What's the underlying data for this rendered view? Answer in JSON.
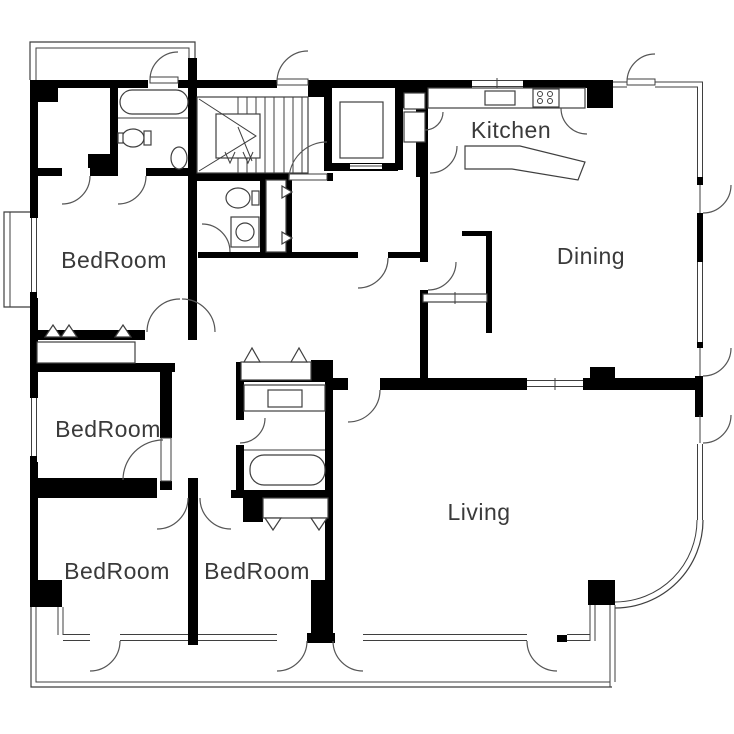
{
  "plan": {
    "rooms": [
      {
        "id": "kitchen",
        "label": "Kitchen"
      },
      {
        "id": "dining",
        "label": "Dining"
      },
      {
        "id": "living",
        "label": "Living"
      },
      {
        "id": "bedroom-nw",
        "label": "BedRoom"
      },
      {
        "id": "bedroom-w",
        "label": "BedRoom"
      },
      {
        "id": "bedroom-sw",
        "label": "BedRoom"
      },
      {
        "id": "bedroom-s",
        "label": "BedRoom"
      }
    ],
    "fixtures": [
      "staircase-icon",
      "elevator-icon",
      "bathtub-icon",
      "toilet-icon",
      "wash-basin-icon",
      "washing-machine-icon",
      "kitchen-counter-icon",
      "sink-icon",
      "stove-icon",
      "kitchen-island-icon",
      "closet-icon",
      "door-arc-icon",
      "window-icon",
      "balcony-icon"
    ],
    "colors": {
      "wall": "#000000",
      "thin_line": "#3f3f3f",
      "background": "#ffffff",
      "label_text": "#3a3a3a"
    }
  }
}
